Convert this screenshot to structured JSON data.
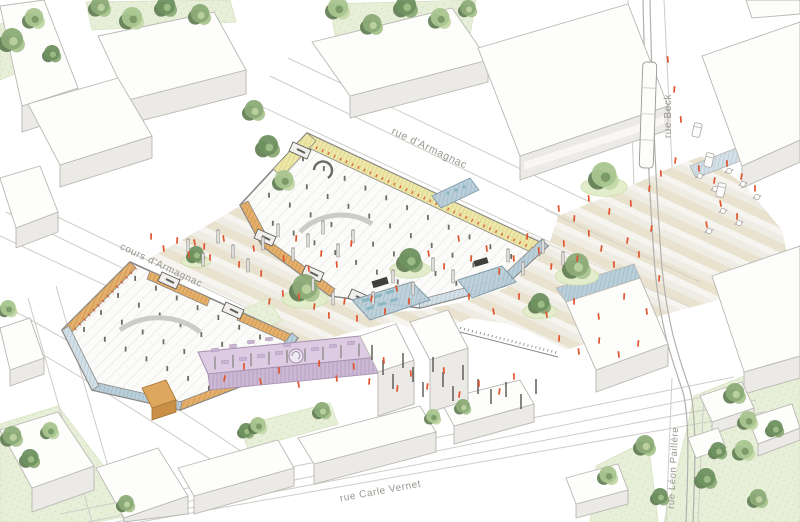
{
  "scene_title": "axonometric urban site plan",
  "palette": {
    "background": "#ffffff",
    "outline": "#b9b7b2",
    "outline_dark": "#7f7d79",
    "building_top": "#fdfdfc",
    "building_wall": "#eceae6",
    "building_wall_dark": "#e0dedal",
    "road_line": "#cfcdc8",
    "lawn": "#e8efd9",
    "lawn_dot": "#cfe0b4",
    "mound": "#e3edcb",
    "stripe_a": "#e9e2cf",
    "stripe_b": "#f6f4ee",
    "stripe_c": "#efece3",
    "parking_bg": "#fbfbf9",
    "parking_line": "#e3e1dc",
    "hall_edge": "#8b8985",
    "wood_yellow": "#ede8a9",
    "wood_yellow_line": "#d6cc7d",
    "wood_orange": "#e5b06d",
    "wood_orange_line": "#c7913f",
    "red_tick": "#d9542e",
    "glass": "#b9cfda",
    "glass_light": "#d3e0e8",
    "glass_frame": "#7d97a6",
    "teal": "#85b5bf",
    "purple": "#dccbe2",
    "purple_dark": "#c8b4d2",
    "purple_wall": "#cbb8d3",
    "people": "#e0542e",
    "post_fill": "#dddcd8",
    "post_stroke": "#8e8c88",
    "pole_dark": "#56544f",
    "track": "#b2b0ab",
    "label_color": "#98968f"
  },
  "tree_greens": [
    "#6f9160",
    "#8cab77",
    "#a9c58f",
    "#c4d8a8"
  ],
  "tree_dark": "#5d7a50",
  "street_labels": [
    {
      "id": "rue-d-armagnac",
      "text": "rue d'Armagnac",
      "x": 428,
      "y": 151,
      "rotate": 25.4,
      "size": 10.5
    },
    {
      "id": "cours-d-armagnac",
      "text": "cours d'Armagnac",
      "x": 160,
      "y": 268,
      "rotate": 25.5,
      "size": 10
    },
    {
      "id": "rue-beck",
      "text": "rue Beck",
      "x": 671,
      "y": 116,
      "rotate": -90,
      "size": 10
    },
    {
      "id": "rue-carle-vernet",
      "text": "rue Carle Vernet",
      "x": 381,
      "y": 494,
      "rotate": -10.5,
      "size": 10
    },
    {
      "id": "rue-leon-paillere",
      "text": "rue Léon Paillère",
      "x": 676,
      "y": 468,
      "rotate": -87,
      "size": 9.5
    }
  ],
  "trees": [
    [
      12,
      42,
      14,
      1,
      0
    ],
    [
      34,
      20,
      12,
      2,
      0
    ],
    [
      52,
      55,
      10,
      0,
      0
    ],
    [
      100,
      8,
      12,
      1,
      0
    ],
    [
      132,
      20,
      13,
      2,
      0
    ],
    [
      166,
      8,
      12,
      0,
      0
    ],
    [
      200,
      16,
      12,
      1,
      0
    ],
    [
      338,
      10,
      13,
      2,
      0
    ],
    [
      372,
      26,
      12,
      1,
      0
    ],
    [
      406,
      8,
      13,
      0,
      0
    ],
    [
      440,
      20,
      12,
      2,
      0
    ],
    [
      468,
      10,
      10,
      1,
      0
    ],
    [
      254,
      112,
      12,
      1,
      0
    ],
    [
      268,
      148,
      13,
      0,
      0
    ],
    [
      284,
      182,
      12,
      2,
      0
    ],
    [
      196,
      256,
      10,
      0,
      1
    ],
    [
      305,
      290,
      16,
      1,
      1
    ],
    [
      410,
      262,
      14,
      0,
      1
    ],
    [
      604,
      178,
      16,
      2,
      1
    ],
    [
      577,
      268,
      15,
      1,
      1
    ],
    [
      540,
      305,
      12,
      0,
      1
    ],
    [
      735,
      395,
      12,
      1,
      0
    ],
    [
      748,
      422,
      11,
      2,
      0
    ],
    [
      706,
      480,
      12,
      0,
      0
    ],
    [
      645,
      447,
      12,
      1,
      0
    ],
    [
      608,
      477,
      11,
      2,
      0
    ],
    [
      660,
      498,
      10,
      0,
      0
    ],
    [
      744,
      452,
      12,
      2,
      0
    ],
    [
      758,
      500,
      11,
      1,
      0
    ],
    [
      775,
      430,
      10,
      0,
      0
    ],
    [
      718,
      452,
      10,
      0,
      0
    ],
    [
      12,
      438,
      12,
      1,
      0
    ],
    [
      30,
      460,
      11,
      0,
      0
    ],
    [
      50,
      432,
      10,
      2,
      0
    ],
    [
      126,
      505,
      10,
      1,
      0
    ],
    [
      246,
      432,
      9,
      0,
      0
    ],
    [
      258,
      427,
      10,
      2,
      0
    ],
    [
      322,
      412,
      10,
      1,
      0
    ],
    [
      8,
      310,
      10,
      2,
      0
    ],
    [
      433,
      418,
      9,
      2,
      0
    ],
    [
      463,
      408,
      9,
      1,
      0
    ]
  ],
  "people": [
    [
      195,
      245
    ],
    [
      210,
      260
    ],
    [
      224,
      241
    ],
    [
      239,
      267
    ],
    [
      254,
      251
    ],
    [
      261,
      276
    ],
    [
      284,
      261
    ],
    [
      296,
      241
    ],
    [
      309,
      271
    ],
    [
      321,
      256
    ],
    [
      337,
      267
    ],
    [
      351,
      246
    ],
    [
      299,
      299
    ],
    [
      314,
      309
    ],
    [
      283,
      296
    ],
    [
      269,
      304
    ],
    [
      329,
      318
    ],
    [
      344,
      304
    ],
    [
      357,
      321
    ],
    [
      371,
      301
    ],
    [
      385,
      314
    ],
    [
      397,
      291
    ],
    [
      409,
      304
    ],
    [
      429,
      256
    ],
    [
      444,
      269
    ],
    [
      459,
      241
    ],
    [
      471,
      261
    ],
    [
      487,
      251
    ],
    [
      499,
      274
    ],
    [
      514,
      261
    ],
    [
      527,
      239
    ],
    [
      539,
      253
    ],
    [
      551,
      269
    ],
    [
      564,
      246
    ],
    [
      577,
      261
    ],
    [
      589,
      236
    ],
    [
      601,
      251
    ],
    [
      614,
      267
    ],
    [
      627,
      243
    ],
    [
      639,
      257
    ],
    [
      651,
      231
    ],
    [
      469,
      299
    ],
    [
      494,
      314
    ],
    [
      519,
      299
    ],
    [
      547,
      317
    ],
    [
      574,
      304
    ],
    [
      599,
      319
    ],
    [
      624,
      299
    ],
    [
      647,
      314
    ],
    [
      659,
      281
    ],
    [
      559,
      211
    ],
    [
      574,
      221
    ],
    [
      589,
      201
    ],
    [
      609,
      214
    ],
    [
      631,
      206
    ],
    [
      649,
      191
    ],
    [
      661,
      176
    ],
    [
      675,
      163
    ],
    [
      699,
      171
    ],
    [
      714,
      183
    ],
    [
      727,
      166
    ],
    [
      741,
      179
    ],
    [
      755,
      191
    ],
    [
      721,
      206
    ],
    [
      737,
      219
    ],
    [
      707,
      227
    ],
    [
      151,
      239
    ],
    [
      164,
      251
    ],
    [
      177,
      243
    ],
    [
      189,
      257
    ],
    [
      204,
      249
    ],
    [
      354,
      369
    ],
    [
      369,
      384
    ],
    [
      384,
      363
    ],
    [
      397,
      391
    ],
    [
      411,
      376
    ],
    [
      427,
      389
    ],
    [
      444,
      373
    ],
    [
      459,
      397
    ],
    [
      479,
      386
    ],
    [
      499,
      394
    ],
    [
      514,
      379
    ],
    [
      224,
      381
    ],
    [
      244,
      369
    ],
    [
      261,
      384
    ],
    [
      279,
      373
    ],
    [
      299,
      387
    ],
    [
      319,
      366
    ],
    [
      337,
      381
    ],
    [
      559,
      341
    ],
    [
      579,
      354
    ],
    [
      599,
      343
    ],
    [
      619,
      357
    ],
    [
      638,
      346
    ],
    [
      668,
      62
    ],
    [
      674,
      92
    ],
    [
      681,
      122
    ]
  ],
  "plaza_posts": [
    [
      188,
      252
    ],
    [
      203,
      266
    ],
    [
      218,
      243
    ],
    [
      233,
      258
    ],
    [
      248,
      272
    ],
    [
      263,
      250
    ],
    [
      278,
      237
    ],
    [
      293,
      261
    ],
    [
      308,
      247
    ],
    [
      323,
      234
    ],
    [
      338,
      257
    ],
    [
      353,
      243
    ],
    [
      313,
      291
    ],
    [
      333,
      305
    ],
    [
      373,
      305
    ],
    [
      393,
      283
    ],
    [
      413,
      295
    ],
    [
      433,
      271
    ],
    [
      453,
      283
    ],
    [
      508,
      262
    ],
    [
      523,
      275
    ],
    [
      543,
      253
    ],
    [
      563,
      265
    ]
  ],
  "dark_poles": [
    [
      372,
      360
    ],
    [
      383,
      375
    ],
    [
      393,
      389
    ],
    [
      403,
      368
    ],
    [
      413,
      382
    ],
    [
      423,
      397
    ],
    [
      433,
      372
    ],
    [
      443,
      387
    ],
    [
      453,
      401
    ],
    [
      463,
      380
    ],
    [
      478,
      394
    ],
    [
      491,
      404
    ],
    [
      506,
      397
    ],
    [
      521,
      409
    ],
    [
      536,
      394
    ]
  ],
  "cafe_tables": [
    [
      700,
      176
    ],
    [
      715,
      189
    ],
    [
      729,
      171
    ],
    [
      743,
      184
    ],
    [
      757,
      197
    ],
    [
      723,
      211
    ],
    [
      739,
      223
    ],
    [
      709,
      231
    ]
  ],
  "cars": [
    [
      697,
      130,
      13
    ],
    [
      709,
      160,
      13
    ],
    [
      721,
      190,
      13
    ]
  ],
  "terrace_furniture": [
    [
      215,
      350
    ],
    [
      233,
      346
    ],
    [
      251,
      342
    ],
    [
      269,
      339
    ],
    [
      287,
      345
    ],
    [
      225,
      362
    ],
    [
      243,
      359
    ],
    [
      261,
      356
    ],
    [
      279,
      353
    ],
    [
      297,
      360
    ],
    [
      315,
      349
    ],
    [
      333,
      346
    ],
    [
      351,
      343
    ]
  ]
}
